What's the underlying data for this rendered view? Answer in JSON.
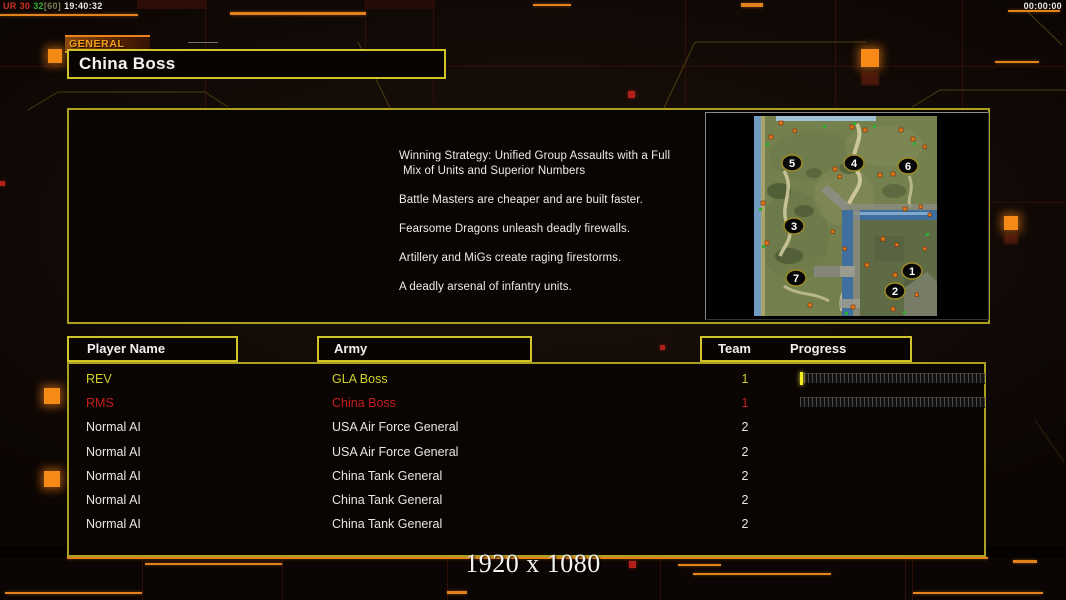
{
  "status_left": {
    "ur": "UR",
    "a": "30",
    "b": "32",
    "c": "[60]",
    "clock": "19:40:32"
  },
  "status_right": {
    "timer": "00:00:00"
  },
  "header": {
    "tab_label": "GENERAL",
    "title": "China Boss"
  },
  "briefing": {
    "lines": [
      "Winning Strategy: Unified Group Assaults with a Full",
      "Mix of Units and Superior Numbers",
      "Battle Masters are cheaper and are built faster.",
      "Fearsome Dragons unleash deadly firewalls.",
      "Artillery and MiGs create raging firestorms.",
      "A deadly arsenal of infantry units."
    ]
  },
  "map_preview": {
    "start_positions": [
      "1",
      "2",
      "3",
      "4",
      "5",
      "6",
      "7"
    ]
  },
  "table": {
    "headers": {
      "player": "Player Name",
      "army": "Army",
      "team": "Team",
      "progress": "Progress"
    },
    "rows": [
      {
        "player": "REV",
        "army": "GLA Boss",
        "team": "1",
        "color": "#d0d028",
        "progress": "started"
      },
      {
        "player": "RMS",
        "army": "China Boss",
        "team": "1",
        "color": "#c41e1e",
        "progress": "empty"
      },
      {
        "player": "Normal AI",
        "army": "USA Air Force General",
        "team": "2",
        "color": "#e6e6e6",
        "progress": "none"
      },
      {
        "player": "Normal AI",
        "army": "USA Air Force General",
        "team": "2",
        "color": "#e6e6e6",
        "progress": "none"
      },
      {
        "player": "Normal AI",
        "army": "China Tank General",
        "team": "2",
        "color": "#e6e6e6",
        "progress": "none"
      },
      {
        "player": "Normal AI",
        "army": "China Tank General",
        "team": "2",
        "color": "#e6e6e6",
        "progress": "none"
      },
      {
        "player": "Normal AI",
        "army": "China Tank General",
        "team": "2",
        "color": "#e6e6e6",
        "progress": "none"
      }
    ]
  },
  "footer": {
    "resolution": "1920 x 1080"
  },
  "colors": {
    "accent_yellow": "#d0c42a",
    "accent_orange": "#e2821c",
    "player_yellow": "#d0d028",
    "player_red": "#c41e1e",
    "text_white": "#e6e6e6",
    "status_red": "#d03020",
    "status_green": "#30b030"
  }
}
